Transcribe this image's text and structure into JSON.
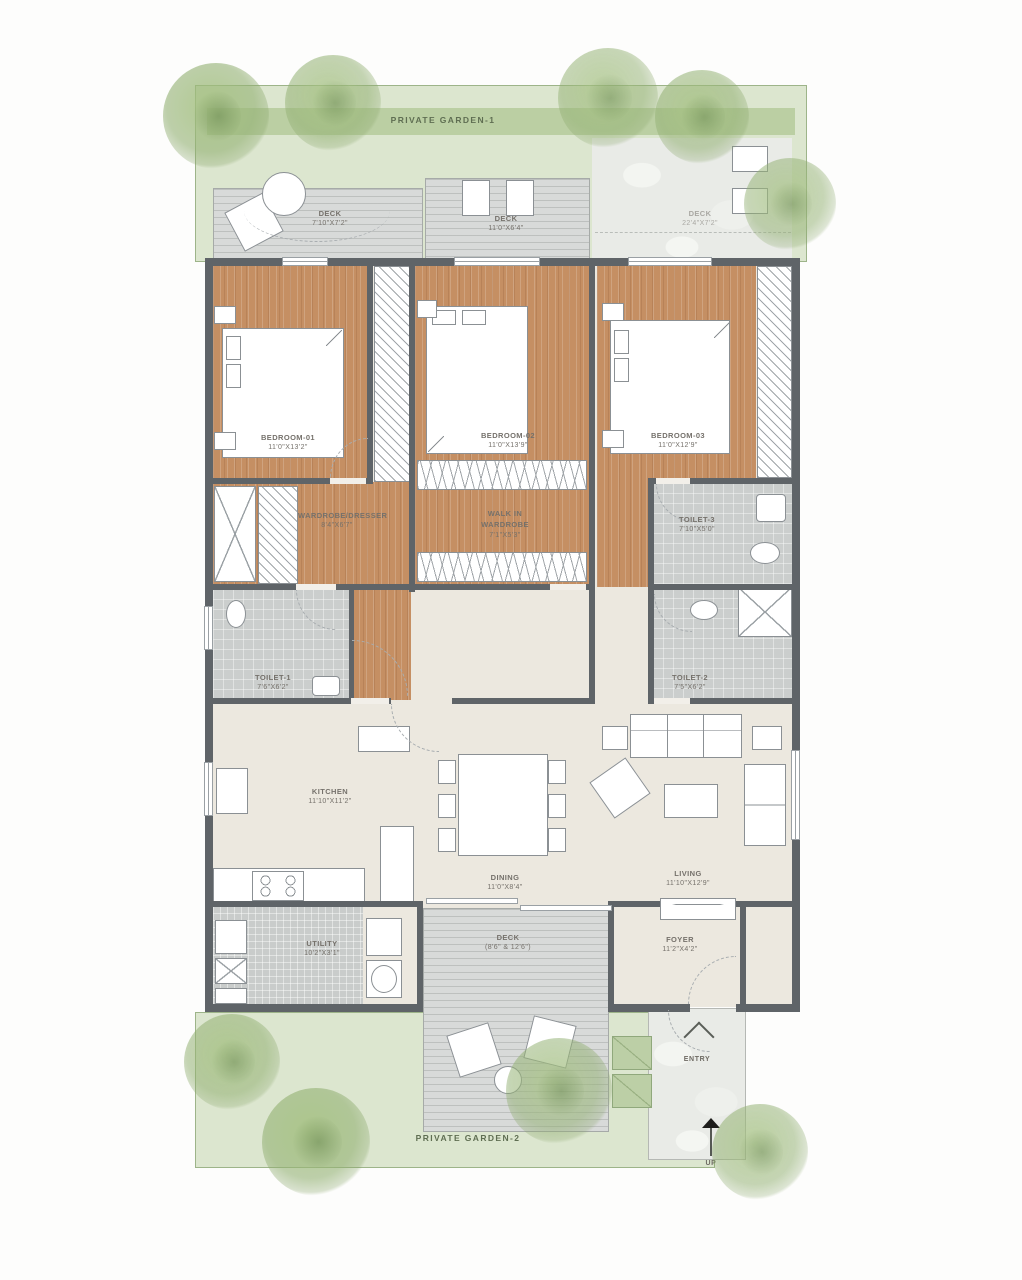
{
  "plan": {
    "gardens": {
      "top": {
        "label": "PRIVATE GARDEN-1"
      },
      "bottom": {
        "label": "PRIVATE GARDEN-2"
      }
    },
    "rooms": {
      "deck_top_left": {
        "name": "DECK",
        "dims": "7'10\"X7'2\""
      },
      "deck_top_mid": {
        "name": "DECK",
        "dims": "11'0\"X6'4\""
      },
      "terrace": {
        "name": "DECK",
        "dims": "22'4\"X7'2\""
      },
      "bedroom_1": {
        "name": "BEDROOM-01",
        "dims": "11'0\"X13'2\""
      },
      "bedroom_2": {
        "name": "BEDROOM-02",
        "dims": "11'0\"X13'9\""
      },
      "bedroom_3": {
        "name": "BEDROOM-03",
        "dims": "11'0\"X12'9\""
      },
      "wardrobe_dresser": {
        "name": "WARDROBE/DRESSER",
        "dims": "8'4\"X6'7\""
      },
      "walk_in_wardrobe": {
        "name": "WALK IN WARDROBE",
        "dims": "7'1\"X5'3\""
      },
      "toilet_1": {
        "name": "TOILET-1",
        "dims": "7'6\"X6'2\""
      },
      "toilet_2": {
        "name": "TOILET-2",
        "dims": "7'5\"X6'2\""
      },
      "toilet_3": {
        "name": "TOILET-3",
        "dims": "7'10\"X5'0\""
      },
      "kitchen": {
        "name": "KITCHEN",
        "dims": "11'10\"X11'2\""
      },
      "dining": {
        "name": "DINING",
        "dims": "11'0\"X8'4\""
      },
      "living": {
        "name": "LIVING",
        "dims": "11'10\"X12'9\""
      },
      "utility": {
        "name": "UTILITY",
        "dims": "10'2\"X3'1\""
      },
      "deck_bottom": {
        "name": "DECK",
        "dims": "(8'6\" & 12'6\")"
      },
      "foyer": {
        "name": "FOYER",
        "dims": "11'2\"X4'2\""
      }
    },
    "markers": {
      "entry": "ENTRY",
      "up": "UP"
    },
    "colors": {
      "wood": "#c58f63",
      "deck": "#d8dad9",
      "tile": "#cbcecd",
      "hall": "#ece8df",
      "wall": "#5f6468",
      "garden": "#b7cd9e",
      "tree": "#9cb886"
    }
  }
}
